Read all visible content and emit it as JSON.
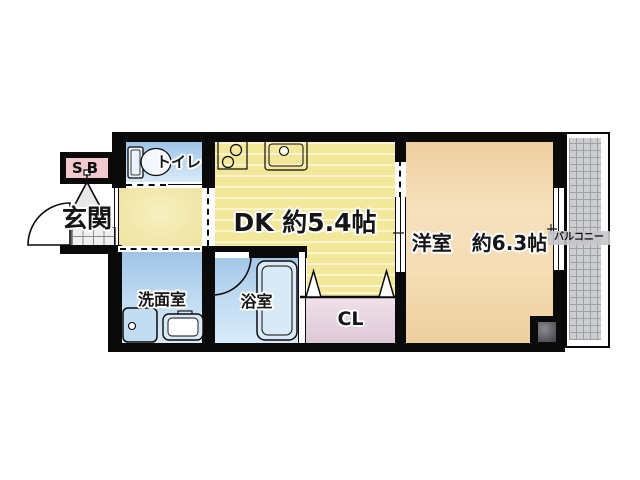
{
  "floor_plan": {
    "type": "japanese-apartment-1dk",
    "rooms": {
      "entrance": {
        "label": "玄関"
      },
      "shoe_box": {
        "label": "SB"
      },
      "toilet": {
        "label": "トイレ"
      },
      "dining_kitchen": {
        "label": "DK 約5.4帖"
      },
      "western_room": {
        "label": "洋室　約6.3帖"
      },
      "washroom": {
        "label": "洗面室"
      },
      "bathroom": {
        "label": "浴室"
      },
      "closet": {
        "label": "CL"
      },
      "balcony": {
        "label": "バルコニー"
      }
    },
    "icons": {
      "toilet-icon": "tank+bowl shape",
      "stove-icon": "two burner circles",
      "kitchen-sink-icon": "basin with faucet circle",
      "washing-machine-icon": "square with dial circle",
      "vanity-sink-icon": "rounded basin",
      "bathtub-icon": "rounded tub",
      "entrance-door-arc-icon": "quarter-circle swing",
      "bath-door-arc-icon": "quarter-circle swing",
      "folding-door-icon": "two triangle peaks",
      "entrance-pivot-icon": "triangle cone",
      "pipe-shaft-icon": "dark gray square"
    },
    "colors": {
      "wall": "#0a0a0a",
      "dk_floor": "#f3e79a",
      "hall_floor": "#f0e4a4",
      "western_floor": "#f2d8ae",
      "wet_area_blue": "#aecfee",
      "closet_pink": "#e3ccd9",
      "shoe_box_pink": "#f2c9ce",
      "balcony_gray": "#cdced2",
      "entrance_tile": "#efefef"
    }
  }
}
